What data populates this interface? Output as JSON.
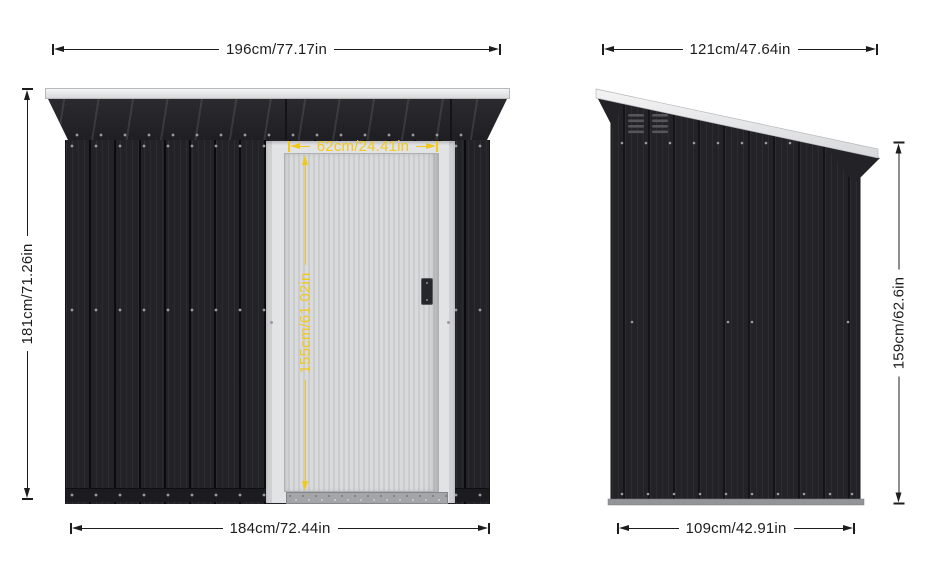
{
  "product": "pent-roof metal storage shed dimension diagram",
  "views": {
    "front": {
      "overall_width_label": "196cm/77.17in",
      "overall_height_label": "181cm/71.26in",
      "base_width_label": "184cm/72.44in",
      "door": {
        "width_label": "62cm/24.41in",
        "height_label": "155cm/61.02in"
      }
    },
    "side": {
      "overall_depth_label": "121cm/47.64in",
      "wall_height_label": "159cm/62.6in",
      "base_depth_label": "109cm/42.91in"
    }
  },
  "colors": {
    "background": "#ffffff",
    "wall_dark": "#232327",
    "roof_trim_light": "#e9eaec",
    "door_light": "#d4d5d7",
    "dimension_line": "#1d1d1f",
    "door_dimension_yellow": "#f2c71e"
  }
}
